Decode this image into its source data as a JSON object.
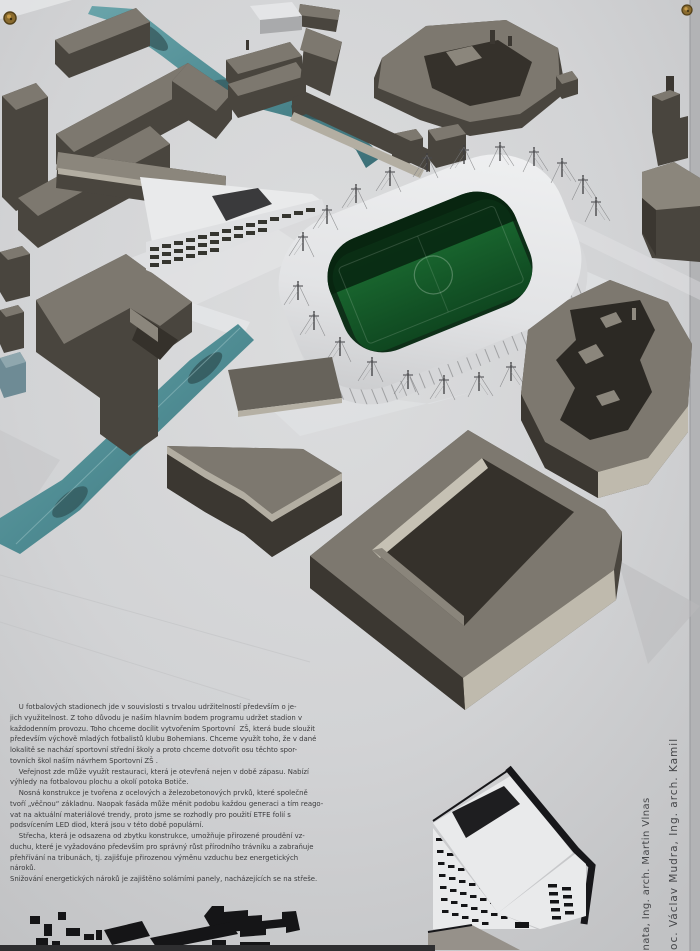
{
  "text_block": {
    "paragraphs": [
      "    U fotbalových stadionech jde v souvislosti s trvalou udržitelností především o je-\njich využitelnost. Z toho důvodu je naším hlavním bodem programu udržet stadion v\nkaždodenním provozu. Toho chceme docílit vytvořením Sportovní  ZŠ, která bude sloužit\npředevším výchově mladých fotbalistů klubu Bohemians. Chceme využít toho, že v dané\nlokalitě se nachází sportovní střední školy a proto chceme dotvořit osu těchto spor-\ntovních škol naším návrhem Sportovní ZŠ .",
      "    Veřejnost zde může využít restauraci, která je otevřená nejen v době zápasu. Nabízí\nvýhledy na fotbalovou plochu a okolí potoka Botiče.",
      "    Nosná konstrukce je tvořena z ocelových a železobetonových prvků, které společně\ntvoří „věčnou“ základnu. Naopak fasáda může měnit podobu každou generaci a tím reago-\nvat na aktuální materiálové trendy, proto jsme se rozhodly pro použití ETFE folií s\npodsvícením LED diod, která jsou v této době populární.",
      "    Střecha, která je odsazena od zbytku konstrukce, umožňuje přirozené proudění vz-\nduchu, které je vyžadováno především pro správný růst přírodního trávníku a zabraňuje\npřehřívání na tribunách, tj. zajišťuje přirozenou výměnu vzduchu bez energetických\nnároků.",
      "Snižování energetických nároků je zajištěno solárními panely, nacházejících se na střeše."
    ]
  },
  "credits": {
    "line1": "anata, Ing. arch. Martin Vlnas",
    "line2": "rátil, doc. Václav Mudra, Ing. arch. Kamil"
  },
  "colors": {
    "paper": "#cdced0",
    "building_top": "#7d786f",
    "building_side": "#49453e",
    "river_teal": "#57939b",
    "pitch_green": "#176029",
    "stadium_white": "#e9eaeb",
    "print_black": "#17171a",
    "text_ink": "#3b3b3d",
    "pin_gold": "#8a6b2e"
  }
}
